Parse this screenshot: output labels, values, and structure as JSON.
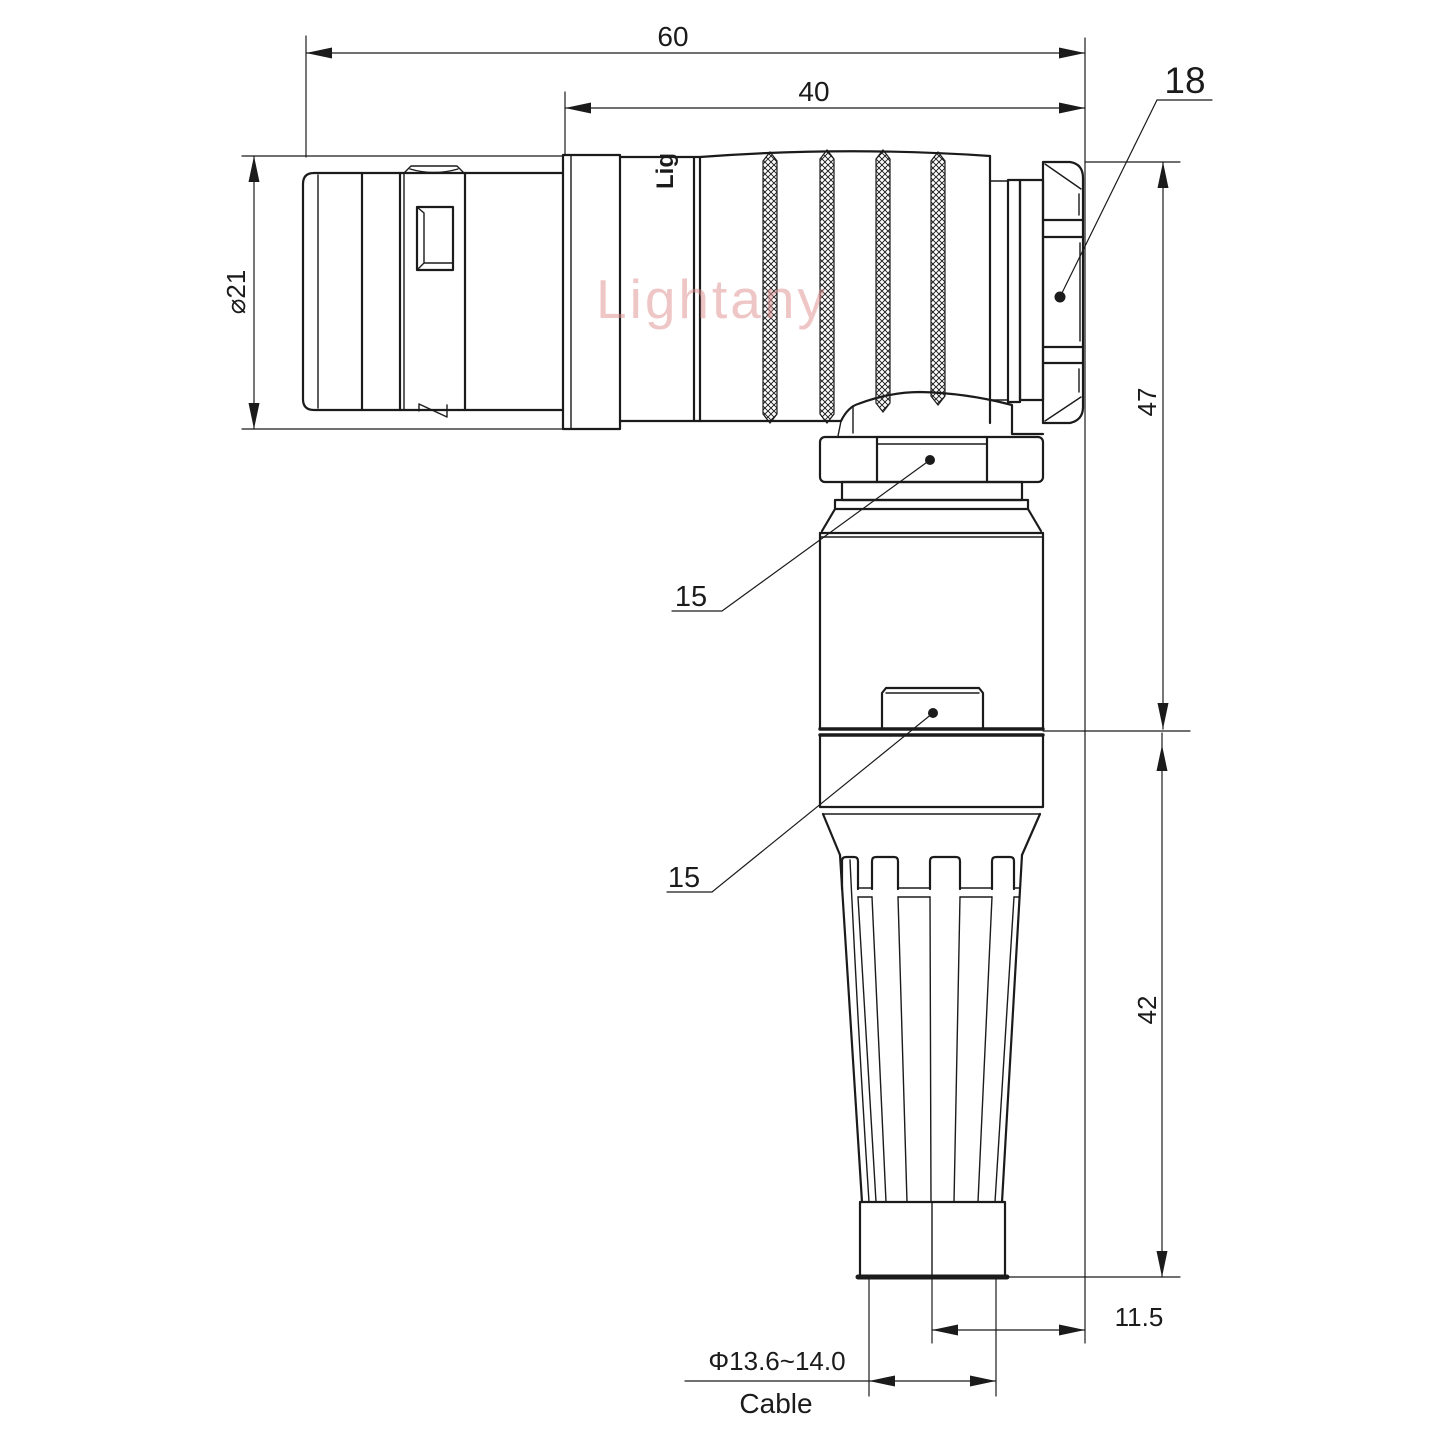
{
  "drawing": {
    "watermark_text": "Lightany",
    "product_marking": "Lig",
    "dimensions": {
      "overall_length": "60",
      "rear_body_length": "40",
      "plug_diameter": "⌀21",
      "nut_size": "18",
      "height_upper": "47",
      "height_lower": "42",
      "axis_offset": "11.5",
      "coupling_callout_upper": "15",
      "coupling_callout_lower": "15",
      "cable_diameter": "Φ13.6~14.0",
      "cable_label": "Cable"
    },
    "colors": {
      "line": "#1b1b1b",
      "watermark": "#e08e8e",
      "background": "#ffffff"
    }
  }
}
